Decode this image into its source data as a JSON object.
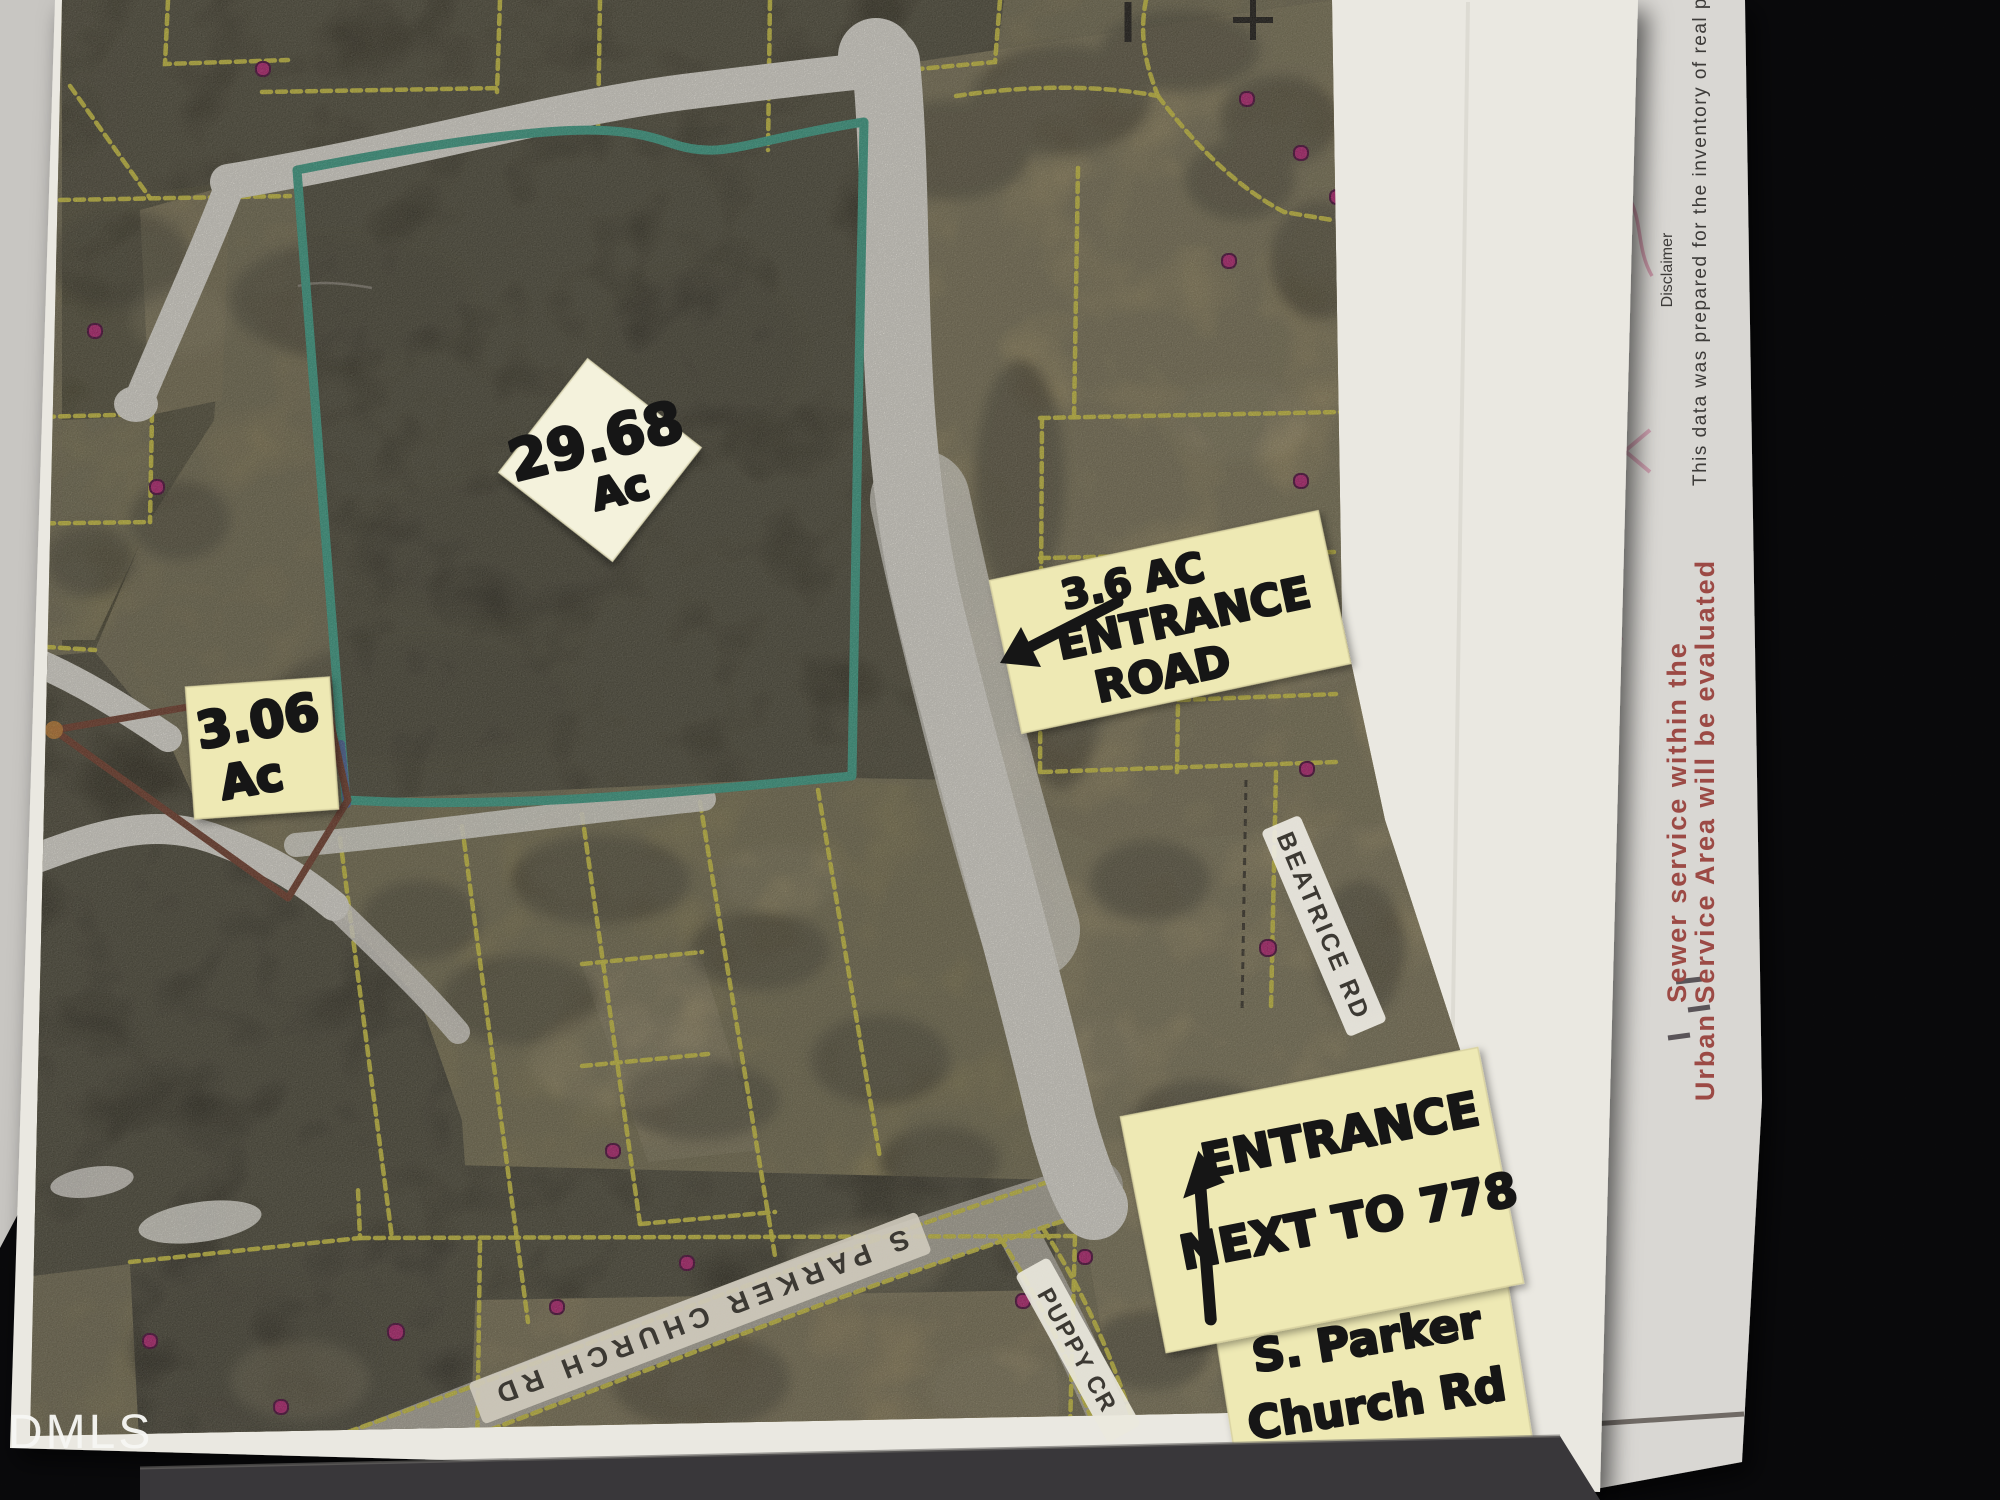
{
  "watermark": "DMLS",
  "notes": {
    "parcel_29_line1": "29.68",
    "parcel_29_line2": "Ac",
    "parcel_306_line1": "3.06",
    "parcel_306_line2": "Ac",
    "entrance_road_line1": "3.6 AC",
    "entrance_road_line2": "ENTRANCE",
    "entrance_road_line3": "ROAD",
    "entrance_778_line1": "ENTRANCE",
    "entrance_778_line2": "NEXT TO 778",
    "parker_note_line1": "S. Parker",
    "parker_note_line2": "Church Rd"
  },
  "road_labels": {
    "beatrice": "BEATRICE RD",
    "parker": "S PARKER CHURCH RD",
    "puppy": "PUPPY CR"
  },
  "side_sheet": {
    "disclaimer_title": "Disclaimer",
    "disclaimer_body": "This data was prepared for the inventory of real property found within this jurisdiction, and",
    "sewer_line1": "Sewer service within the",
    "sewer_line2": "Urban Service Area will be evaluated"
  },
  "colors": {
    "parcel_line_yellow": "#ddd34a",
    "teal_boundary": "#44aa92",
    "maroon_boundary": "#7b4433",
    "sticky_note": "#eee9b4",
    "sticky_note_light": "#f4f2dc",
    "white_out": "#f2efe7",
    "house_dot": "#c22a7d",
    "sewer_text_red": "#9c4a45",
    "background_black": "#0b0b0d"
  }
}
